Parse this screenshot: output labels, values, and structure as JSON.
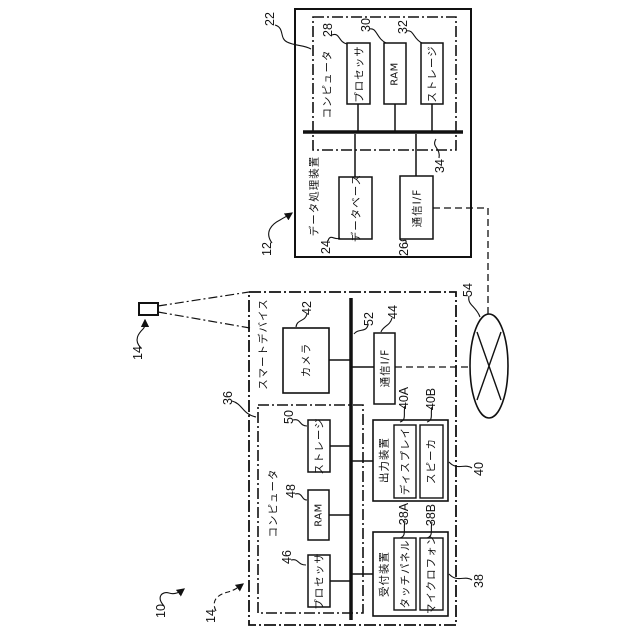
{
  "system": {
    "ref": "10"
  },
  "device_icon": {
    "ref": "14"
  },
  "data_processing_device": {
    "label": "データ処理装置",
    "ref": "12",
    "computer": {
      "label": "コンピュータ",
      "ref": "22"
    },
    "processor": {
      "label": "プロセッサ",
      "ref": "28"
    },
    "ram": {
      "label": "RAM",
      "ref": "30"
    },
    "storage": {
      "label": "ストレージ",
      "ref": "32"
    },
    "bus": {
      "ref": "34"
    },
    "database": {
      "label": "データベース",
      "ref": "24"
    },
    "comm_if": {
      "label": "通信I/F",
      "ref": "26"
    }
  },
  "smart_device": {
    "label": "スマートデバイス",
    "ref": "14",
    "camera": {
      "label": "カメラ",
      "ref": "42"
    },
    "bus": {
      "ref": "52"
    },
    "comm_if": {
      "label": "通信I/F",
      "ref": "44"
    },
    "computer": {
      "label": "コンピュータ",
      "ref": "36"
    },
    "storage": {
      "label": "ストレージ",
      "ref": "50"
    },
    "ram": {
      "label": "RAM",
      "ref": "48"
    },
    "processor": {
      "label": "プロセッサ",
      "ref": "46"
    },
    "output_device": {
      "label": "出力装置",
      "ref": "40",
      "display": {
        "label": "ディスプレイ",
        "ref": "40A"
      },
      "speaker": {
        "label": "スピーカ",
        "ref": "40B"
      }
    },
    "reception_device": {
      "label": "受付装置",
      "ref": "38",
      "touch_panel": {
        "label": "タッチパネル",
        "ref": "38A"
      },
      "microphone": {
        "label": "マイクロフォン",
        "ref": "38B"
      }
    }
  },
  "network": {
    "ref": "54"
  },
  "colors": {
    "line": "#111111",
    "background": "#ffffff"
  }
}
